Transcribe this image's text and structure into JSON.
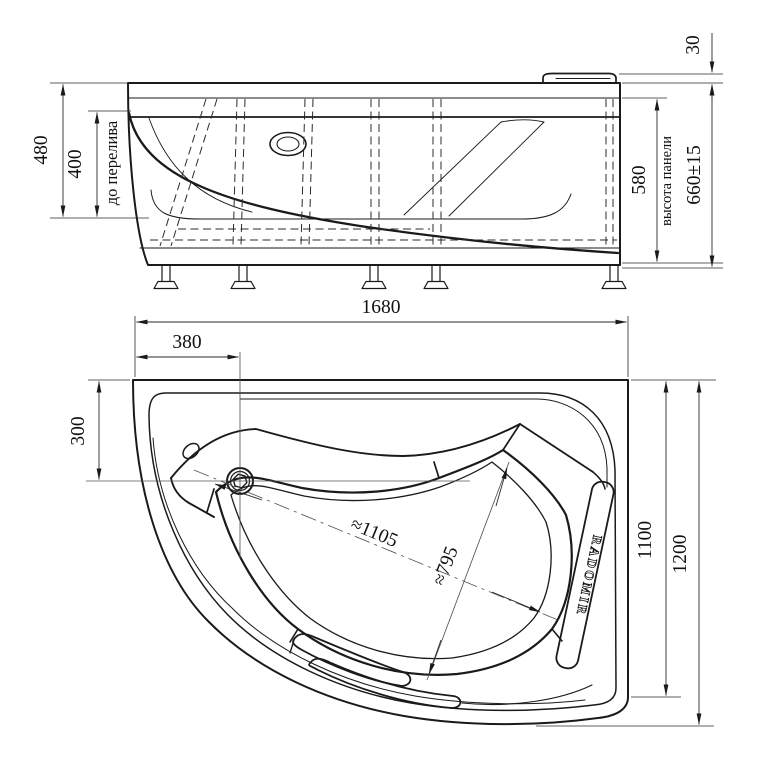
{
  "drawing": {
    "type": "bathtub technical drawing, two orthographic views",
    "colors": {
      "background": "#ffffff",
      "line": "#1a1a1a",
      "dimension": "#2a2a2a"
    }
  },
  "side_view": {
    "dim_480": "480",
    "dim_400": "400",
    "overflow_label": "до перелива",
    "dim_580": "580",
    "panel_label": "высота панели",
    "dim_660": "660±15",
    "dim_30": "30"
  },
  "plan_view": {
    "dim_1680": "1680",
    "dim_380": "380",
    "dim_300": "300",
    "dim_1100": "1100",
    "dim_1200": "1200",
    "dim_diag_long": "≈1105",
    "dim_diag_short": "≈795",
    "brand": "RADOMIR"
  }
}
